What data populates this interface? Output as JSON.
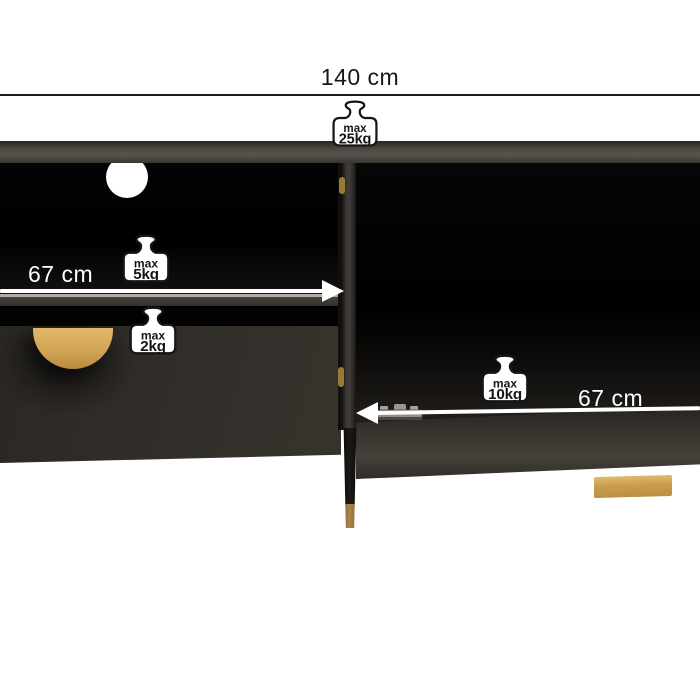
{
  "dimensions": {
    "top_width": "140 cm",
    "left_inner_width": "67 cm",
    "right_inner_width": "67 cm"
  },
  "weight_limits": {
    "top_panel": {
      "prefix": "max",
      "value": "25kg"
    },
    "left_shelf": {
      "prefix": "max",
      "value": "5kg"
    },
    "drawer": {
      "prefix": "max",
      "value": "2kg"
    },
    "right_compartment": {
      "prefix": "max",
      "value": "10kg"
    }
  },
  "colors": {
    "background": "#ffffff",
    "dim-line": "#1a1a1a",
    "arrow": "#ffffff",
    "label-dark": "#161616",
    "label-light": "#ffffff",
    "cabinet-top": "#4c4741",
    "cabinet-body": "#322f2b",
    "interior-black": "#050505",
    "gold-handle": "#d2a656",
    "gold-foot": "#c99c4e",
    "hinge-metal": "#968f88",
    "badge-fill": "#ffffff",
    "badge-outline": "#151515"
  }
}
